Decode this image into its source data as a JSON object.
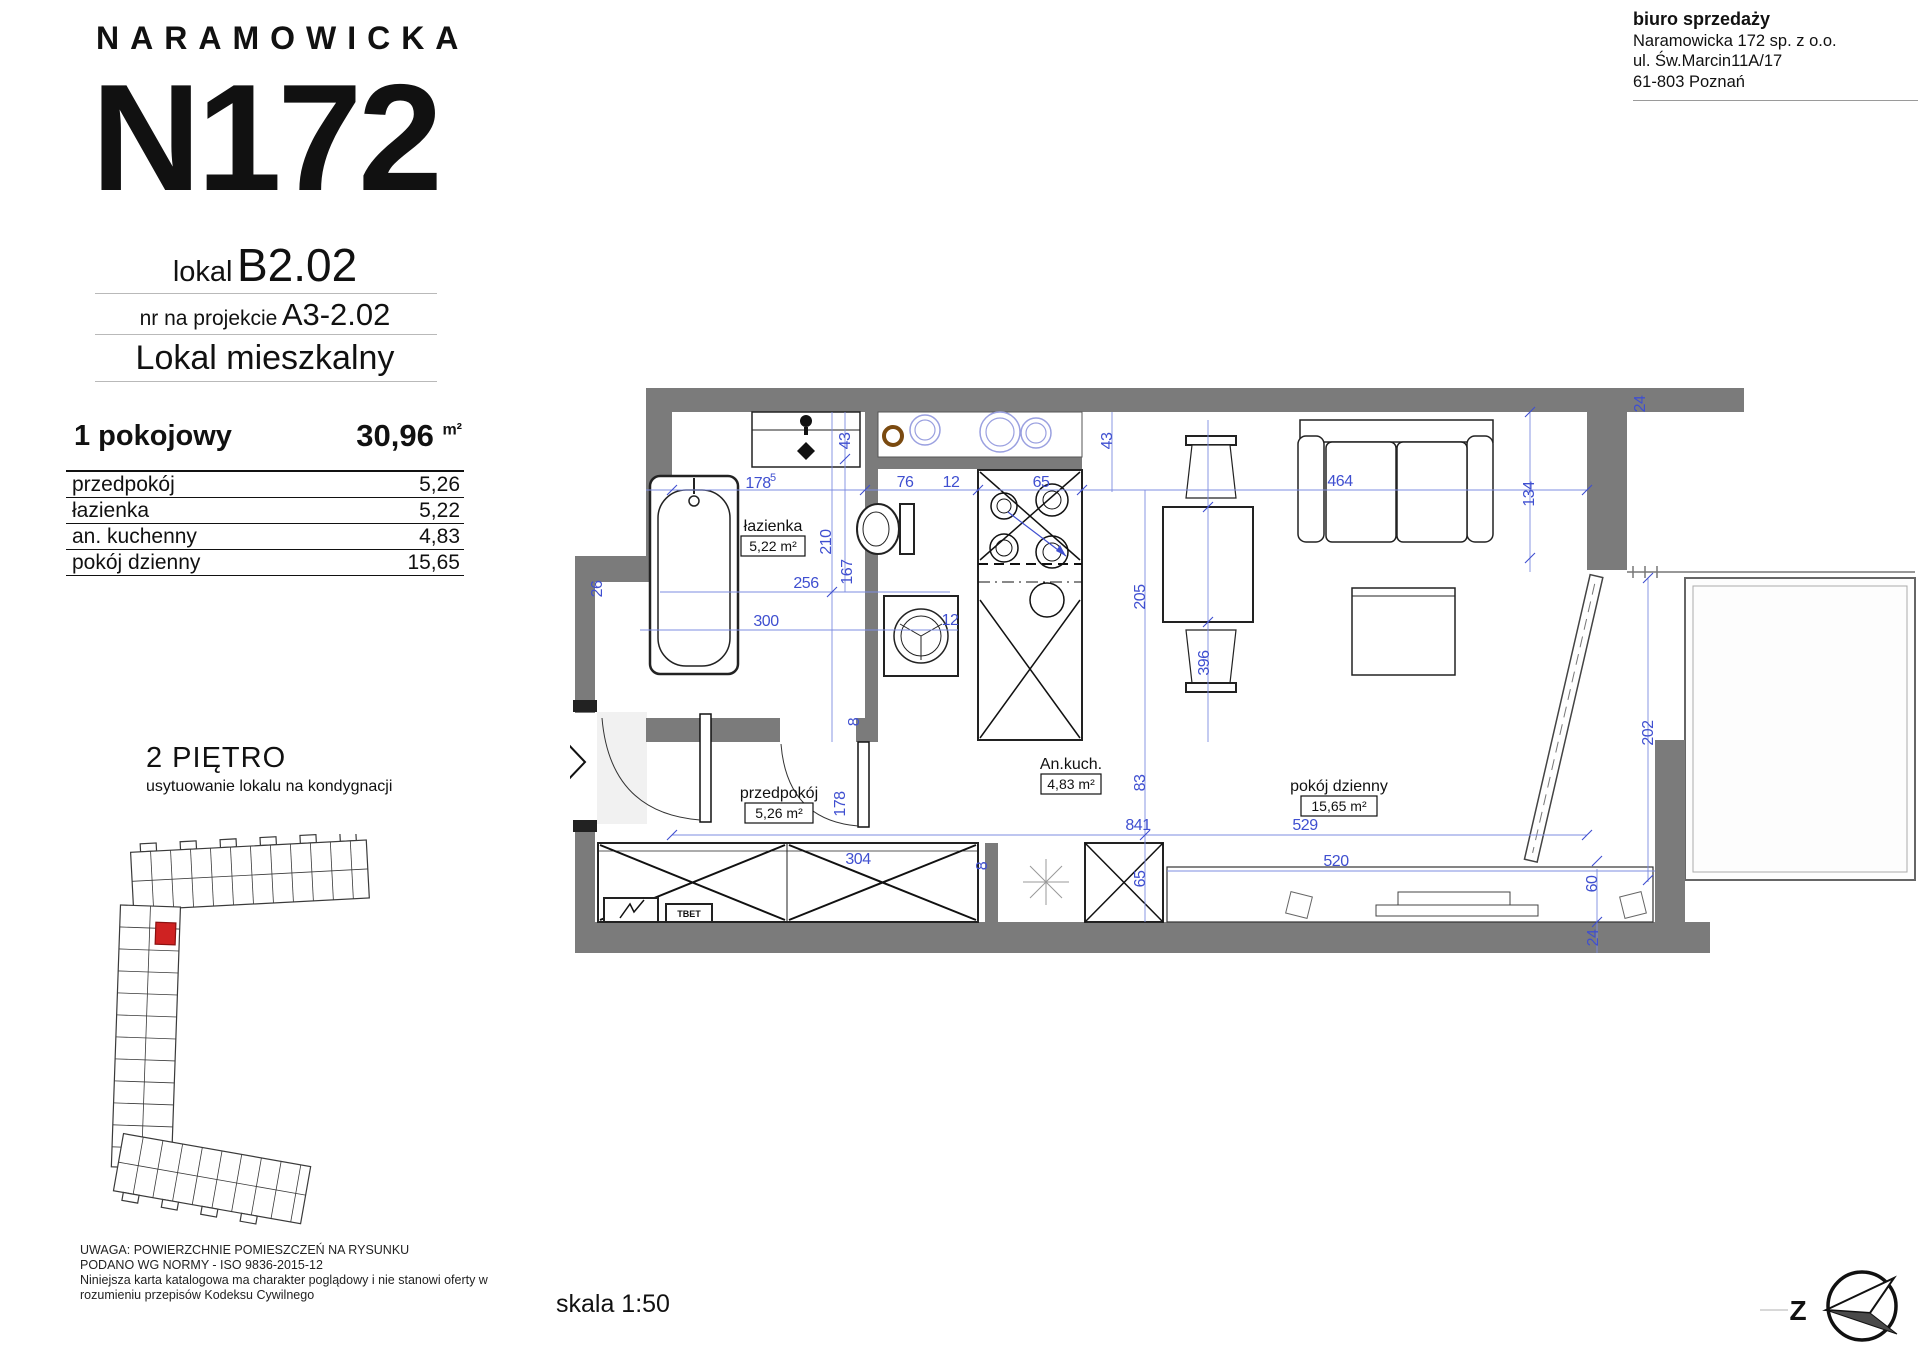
{
  "branding": {
    "name": "NARAMOWICKA",
    "building": "N172"
  },
  "unit": {
    "lokal_label": "lokal",
    "lokal": "B2.02",
    "project_label": "nr na projekcie",
    "project": "A3-2.02",
    "type": "Lokal mieszkalny"
  },
  "office": {
    "line1": "biuro sprzedaży",
    "line2": "Naramowicka 172 sp. z o.o.",
    "line3": "ul. Św.Marcin11A/17",
    "line4": "61-803 Poznań"
  },
  "summary": {
    "layout": "1 pokojowy",
    "area": "30,96",
    "area_unit": "m²"
  },
  "rooms": [
    {
      "name": "przedpokój",
      "area": "5,26"
    },
    {
      "name": "łazienka",
      "area": "5,22"
    },
    {
      "name": "an. kuchenny",
      "area": "4,83"
    },
    {
      "name": "pokój dzienny",
      "area": "15,65"
    }
  ],
  "floor": {
    "title": "2 PIĘTRO",
    "subtitle": "usytuowanie lokalu na kondygnacji"
  },
  "plan": {
    "marker": "A3-2.02",
    "scale": "skala 1:50",
    "compass": "Z",
    "panel_label": "TBET",
    "labels": [
      {
        "name": "łazienka",
        "area": "5,22 m²"
      },
      {
        "name": "przedpokój",
        "area": "5,26 m²"
      },
      {
        "name": "An.kuch.",
        "area": "4,83 m²"
      },
      {
        "name": "pokój dzienny",
        "area": "15,65 m²"
      }
    ],
    "dims": [
      "178",
      "5",
      "43",
      "76",
      "12",
      "65",
      "43",
      "464",
      "134",
      "24",
      "210",
      "167",
      "256",
      "300",
      "12",
      "205",
      "529",
      "396",
      "202",
      "83",
      "841",
      "65",
      "178",
      "304",
      "8",
      "8",
      "520",
      "60",
      "24",
      "26"
    ]
  },
  "disclaimer": [
    "UWAGA: POWIERZCHNIE POMIESZCZEŃ NA RYSUNKU",
    "PODANO WG NORMY - ISO 9836-2015-12",
    "Niniejsza karta katalogowa ma charakter poglądowy i nie stanowi oferty w",
    "rozumieniu przepisów Kodeksu Cywilnego"
  ]
}
